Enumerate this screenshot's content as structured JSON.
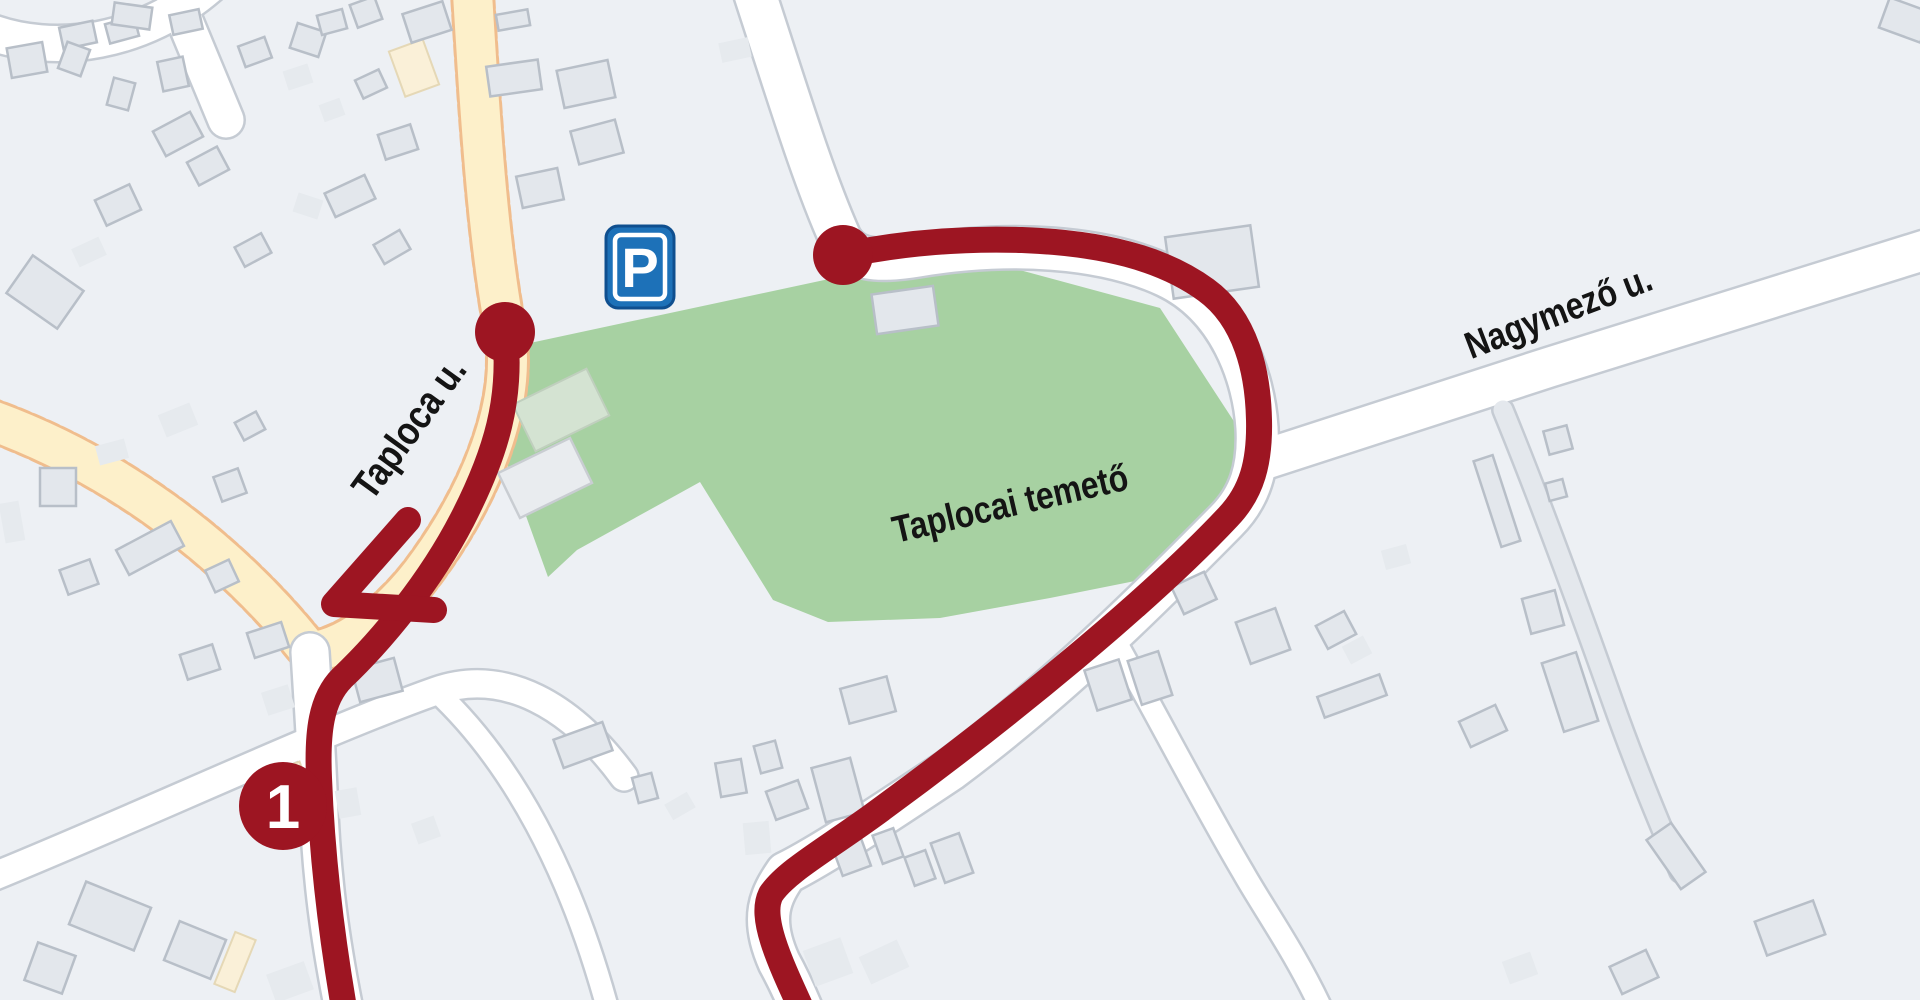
{
  "map": {
    "width": 1920,
    "height": 1000,
    "colors": {
      "background": "#edf0f4",
      "route": "#9d1522",
      "cemetery_green": "#a7d1a2",
      "yellow_road_fill": "#fdf0ca",
      "yellow_road_casing": "#f0bd8d",
      "white_road_fill": "#ffffff",
      "white_road_casing": "#c5cbd3",
      "lane_fill": "#e4e8ed",
      "building_fill": "#e3e7ec",
      "building_stroke": "#b8bfc8",
      "building_flat_fill": "#e6eaee",
      "building_cream_fill": "#faf0d8",
      "building_cream_stroke": "#e5d8b6",
      "shed_green_fill": "#d4e3d2",
      "shed_green_stroke": "#c0cfbe",
      "shed_white_fill": "#e9ecef",
      "shed_white_stroke": "#c9cdd2",
      "label_text": "#141414",
      "parking_blue": "#1d71b8",
      "parking_border": "#0f4f8f"
    },
    "areas": {
      "cemetery_points": "530,343 843,276 1005,266 1160,308 1237,426 1232,500 1140,580 1050,598 940,618 828,622 773,600 700,482 577,550 548,577 495,430"
    },
    "roads": {
      "segments": [
        {
          "name": "taploca-u-north",
          "kind": "yellow",
          "w": 45,
          "path": "M 472 -15 C 480 120 488 240 505 330 C 518 405 478 495 430 562 C 398 608 350 648 310 652"
        },
        {
          "name": "west-street",
          "kind": "yellow",
          "w": 45,
          "path": "M -15 418 C 110 462 225 545 310 652"
        },
        {
          "name": "top-left-curve",
          "kind": "white",
          "w": 40,
          "path": "M -15 30 C 55 58 145 42 210 -15"
        },
        {
          "name": "top-left-stub",
          "kind": "white",
          "w": 40,
          "path": "M 170 -15 L 226 120"
        },
        {
          "name": "cemetery-ring-road",
          "kind": "white",
          "w": 46,
          "path": "M 752 -15 C 788 95 812 175 840 238 C 852 260 876 263 918 256 C 1008 241 1102 246 1166 276 C 1230 306 1254 378 1257 428 C 1259 468 1250 497 1226 521 C 1150 598 1060 688 950 770 C 872 822 820 856 786 873 C 771 895 759 917 779 962 C 790 982 801 1008 801 1008"
        },
        {
          "name": "nagymezo-u",
          "kind": "white",
          "w": 44,
          "path": "M 1257 462 L 1550 367 L 1925 250"
        },
        {
          "name": "south-street",
          "kind": "white",
          "w": 42,
          "path": "M 310 652 C 313 700 316 745 318 790 C 321 880 331 945 344 1010"
        },
        {
          "name": "southwest-street",
          "kind": "white",
          "w": 32,
          "path": "M -15 880 C 145 815 320 732 436 691 C 505 667 572 706 624 777"
        },
        {
          "name": "southeast-lane",
          "kind": "white",
          "w": 26,
          "path": "M 436 691 C 512 762 570 870 608 1010"
        },
        {
          "name": "cemetery-south-lane",
          "kind": "white",
          "w": 26,
          "path": "M 1108 628 C 1152 706 1205 808 1243 872 C 1262 906 1295 952 1322 1010"
        },
        {
          "name": "east-field-lane",
          "kind": "lane",
          "w": 24,
          "path": "M 1503 410 C 1540 500 1580 610 1612 700 C 1635 765 1658 820 1680 872"
        }
      ]
    },
    "buildings": {
      "items": [
        [
          27,
          60,
          36,
          30,
          -10,
          0
        ],
        [
          78,
          35,
          34,
          22,
          -12,
          0
        ],
        [
          122,
          30,
          30,
          20,
          -15,
          0
        ],
        [
          74,
          59,
          24,
          28,
          20,
          0
        ],
        [
          173,
          74,
          26,
          30,
          -12,
          0
        ],
        [
          121,
          94,
          22,
          28,
          15,
          0
        ],
        [
          178,
          134,
          42,
          28,
          -28,
          0
        ],
        [
          208,
          166,
          34,
          26,
          -28,
          0
        ],
        [
          118,
          205,
          38,
          28,
          -25,
          0
        ],
        [
          89,
          252,
          30,
          20,
          -25,
          1
        ],
        [
          45,
          292,
          62,
          46,
          35,
          0
        ],
        [
          255,
          52,
          28,
          22,
          -20,
          0
        ],
        [
          308,
          40,
          30,
          26,
          18,
          0
        ],
        [
          332,
          22,
          26,
          20,
          -15,
          0
        ],
        [
          366,
          12,
          26,
          24,
          -20,
          0
        ],
        [
          298,
          77,
          26,
          20,
          -18,
          1
        ],
        [
          332,
          110,
          22,
          18,
          -20,
          1
        ],
        [
          371,
          84,
          26,
          20,
          -25,
          0
        ],
        [
          398,
          142,
          34,
          26,
          -18,
          0
        ],
        [
          350,
          196,
          44,
          26,
          -25,
          0
        ],
        [
          392,
          247,
          30,
          22,
          -30,
          0
        ],
        [
          308,
          206,
          26,
          20,
          18,
          1
        ],
        [
          253,
          250,
          30,
          22,
          -28,
          0
        ],
        [
          414,
          68,
          36,
          48,
          -20,
          2
        ],
        [
          427,
          22,
          42,
          30,
          -18,
          0
        ],
        [
          513,
          20,
          32,
          16,
          -10,
          0
        ],
        [
          514,
          78,
          52,
          30,
          -8,
          0
        ],
        [
          586,
          84,
          52,
          38,
          -12,
          0
        ],
        [
          597,
          142,
          46,
          34,
          -15,
          0
        ],
        [
          540,
          188,
          42,
          32,
          -12,
          0
        ],
        [
          735,
          50,
          30,
          20,
          -12,
          1
        ],
        [
          132,
          16,
          38,
          22,
          8,
          0
        ],
        [
          186,
          22,
          30,
          20,
          -12,
          0
        ],
        [
          1212,
          262,
          86,
          62,
          -8,
          0
        ],
        [
          561,
          410,
          82,
          52,
          -26,
          3
        ],
        [
          545,
          478,
          80,
          50,
          -26,
          4
        ],
        [
          905,
          310,
          62,
          40,
          -8,
          0
        ],
        [
          58,
          487,
          36,
          38,
          0,
          0
        ],
        [
          150,
          548,
          62,
          28,
          -28,
          0
        ],
        [
          79,
          577,
          32,
          26,
          -20,
          0
        ],
        [
          12,
          522,
          20,
          40,
          -10,
          1
        ],
        [
          222,
          576,
          26,
          24,
          -25,
          0
        ],
        [
          112,
          452,
          30,
          20,
          -15,
          1
        ],
        [
          178,
          420,
          34,
          24,
          -22,
          1
        ],
        [
          230,
          485,
          26,
          26,
          -20,
          0
        ],
        [
          250,
          426,
          24,
          20,
          -28,
          0
        ],
        [
          268,
          640,
          36,
          26,
          -18,
          0
        ],
        [
          200,
          662,
          34,
          26,
          -18,
          0
        ],
        [
          278,
          700,
          28,
          24,
          -18,
          1
        ],
        [
          377,
          680,
          44,
          34,
          -15,
          0
        ],
        [
          348,
          803,
          22,
          28,
          -10,
          1
        ],
        [
          426,
          830,
          24,
          22,
          -20,
          1
        ],
        [
          583,
          745,
          52,
          30,
          -20,
          0
        ],
        [
          645,
          788,
          20,
          26,
          -15,
          0
        ],
        [
          680,
          806,
          26,
          18,
          -30,
          1
        ],
        [
          731,
          778,
          26,
          34,
          -10,
          0
        ],
        [
          768,
          757,
          22,
          28,
          -15,
          0
        ],
        [
          787,
          800,
          34,
          30,
          -20,
          0
        ],
        [
          868,
          700,
          48,
          36,
          -15,
          0
        ],
        [
          838,
          790,
          40,
          56,
          -15,
          0
        ],
        [
          757,
          838,
          26,
          32,
          -5,
          1
        ],
        [
          850,
          852,
          30,
          40,
          -20,
          0
        ],
        [
          888,
          846,
          22,
          30,
          -20,
          0
        ],
        [
          920,
          868,
          22,
          30,
          -20,
          0
        ],
        [
          952,
          858,
          30,
          42,
          -20,
          0
        ],
        [
          828,
          962,
          40,
          38,
          -20,
          1
        ],
        [
          884,
          962,
          42,
          30,
          -25,
          1
        ],
        [
          1108,
          685,
          36,
          42,
          -18,
          0
        ],
        [
          1150,
          678,
          32,
          46,
          -18,
          0
        ],
        [
          1194,
          593,
          36,
          30,
          -25,
          0
        ],
        [
          1191,
          556,
          22,
          16,
          -25,
          1
        ],
        [
          1263,
          636,
          42,
          44,
          -20,
          0
        ],
        [
          1336,
          630,
          32,
          26,
          -28,
          0
        ],
        [
          1357,
          650,
          24,
          20,
          -28,
          1
        ],
        [
          1352,
          696,
          66,
          22,
          -20,
          0
        ],
        [
          1483,
          726,
          40,
          28,
          -25,
          0
        ],
        [
          1396,
          557,
          26,
          20,
          -15,
          1
        ],
        [
          1497,
          501,
          20,
          90,
          -18,
          0
        ],
        [
          1558,
          440,
          24,
          24,
          -15,
          0
        ],
        [
          1556,
          490,
          18,
          18,
          -15,
          0
        ],
        [
          1543,
          612,
          34,
          36,
          -15,
          0
        ],
        [
          1570,
          692,
          36,
          72,
          -18,
          0
        ],
        [
          1676,
          856,
          30,
          60,
          -35,
          0
        ],
        [
          1790,
          928,
          62,
          36,
          -20,
          0
        ],
        [
          1634,
          972,
          40,
          30,
          -25,
          0
        ],
        [
          1520,
          968,
          30,
          24,
          -20,
          1
        ],
        [
          110,
          916,
          70,
          46,
          22,
          0
        ],
        [
          195,
          950,
          50,
          42,
          22,
          0
        ],
        [
          235,
          962,
          22,
          56,
          22,
          2
        ],
        [
          50,
          968,
          40,
          40,
          20,
          0
        ],
        [
          290,
          982,
          40,
          30,
          -20,
          1
        ],
        [
          285,
          786,
          44,
          36,
          -20,
          2
        ],
        [
          1905,
          20,
          44,
          32,
          20,
          0
        ]
      ]
    },
    "route": {
      "width": 26,
      "segments": [
        "M 505 332 C 512 398 497 452 462 520 C 430 582 382 640 342 678 C 321 699 317 732 319 778 C 322 858 331 932 344 1008",
        "M 843 255 C 902 243 962 238 1022 240 C 1102 243 1162 258 1206 290 C 1246 319 1258 372 1259 420 C 1260 462 1252 492 1228 517 C 1152 598 1012 714 872 816 C 822 852 786 872 771 894 C 759 917 779 960 801 1008"
      ],
      "arrow": {
        "barb1": [
          408,
          520
        ],
        "tip": [
          334,
          604
        ],
        "barb2": [
          434,
          610
        ]
      },
      "endpoints": [
        [
          505,
          332
        ],
        [
          843,
          255
        ]
      ],
      "endpoint_radius": 30
    },
    "labels": [
      {
        "id": "taploca",
        "text": "Taploca u.",
        "x": 420,
        "y": 436,
        "rotation": -54,
        "size": 40
      },
      {
        "id": "nagymezo",
        "text": "Nagymező u.",
        "x": 1563,
        "y": 324,
        "rotation": -21,
        "size": 38
      },
      {
        "id": "cemetery",
        "text": "Taplocai temető",
        "x": 1013,
        "y": 516,
        "rotation": -13,
        "size": 38
      }
    ],
    "marker": {
      "number": "1",
      "x": 283,
      "y": 806,
      "radius": 44,
      "text_color": "#ffffff"
    },
    "parking_sign": {
      "letter": "P",
      "x": 606,
      "y": 226,
      "width": 68,
      "height": 82
    }
  }
}
